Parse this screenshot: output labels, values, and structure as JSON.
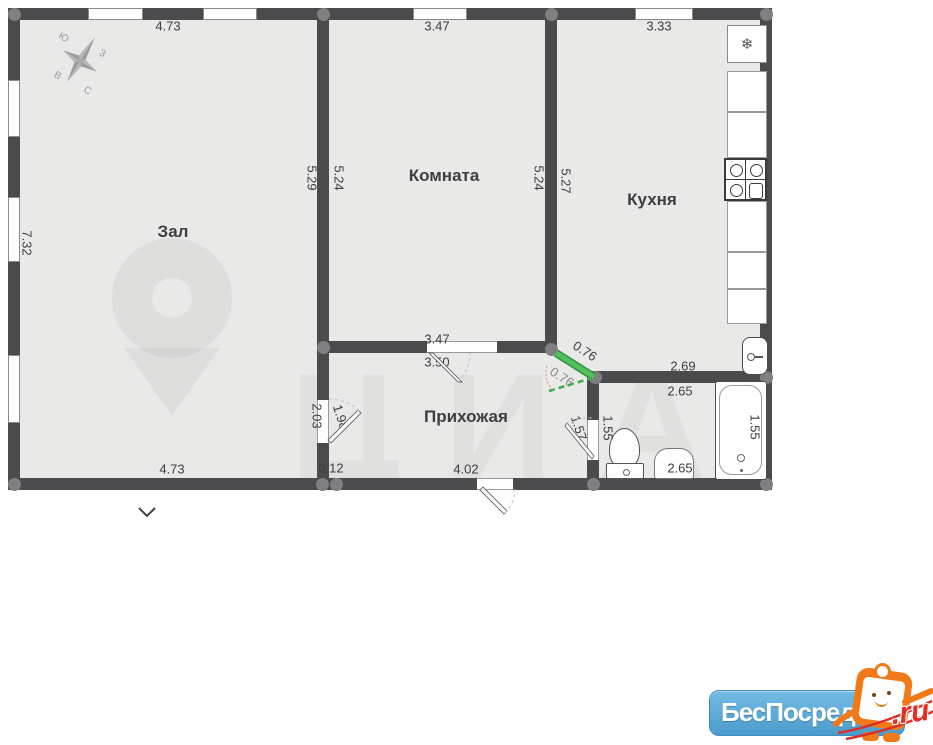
{
  "plan": {
    "rooms": {
      "zal": "Зал",
      "komnata": "Комната",
      "kuhnya": "Кухня",
      "prihozhaya": "Прихожая"
    },
    "dimensions": {
      "top_zal": "4.73",
      "top_komnata": "3.47",
      "top_kuhnya": "3.33",
      "left_zal": "7.32",
      "zal_right": "5.29",
      "komnata_left": "5.24",
      "komnata_right": "5.24",
      "kuhnya_left": "5.27",
      "komnata_bottom": "3.47",
      "prihozhaya_top": "3.50",
      "kitchen_door_a": "0.76",
      "kitchen_door_b": "0.76",
      "kuhnya_bottom": "2.69",
      "bath_top": "2.65",
      "zal_door_a": "2.03",
      "zal_door_b": "1.98",
      "bottom_zal": "4.73",
      "bottom_offset": "0.12",
      "bottom_prihozhaya": "4.02",
      "bath_door_a": "1.57",
      "bath_door_b": "1.55",
      "bath_right": "1.55",
      "bath_bottom": "2.65"
    },
    "compass": {
      "south": "Ю",
      "west": "З",
      "east": "В",
      "north": "С"
    },
    "watermark_text": "ЦИАН",
    "fridge_icon": "❄"
  },
  "branding": {
    "name": "БесПосредника",
    "tld": ".ru"
  },
  "colors": {
    "wall": "#4b4b4d",
    "floor": "#e9e9e8",
    "door_highlight": "#3aab4a",
    "logo_blue": "#4a9ccd",
    "tld_red": "#e52d22"
  }
}
